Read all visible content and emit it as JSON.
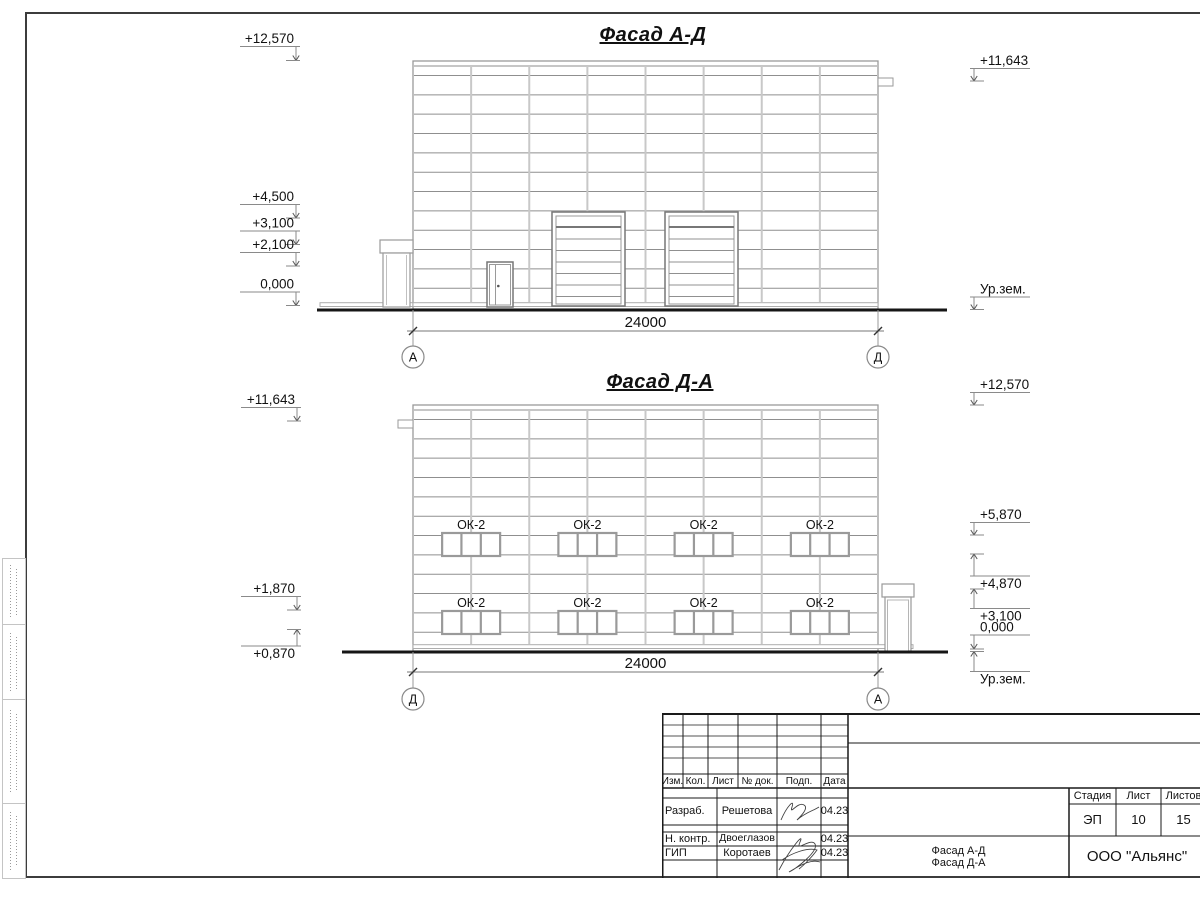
{
  "drawing": {
    "facade_top": {
      "title": "Фасад А-Д",
      "dimension": "24000",
      "axis_left": "А",
      "axis_right": "Д",
      "marks_left": [
        {
          "label": "+12,570",
          "shelf": 46.5,
          "tip": 60.5,
          "dir": "down"
        },
        {
          "label": "+4,500",
          "shelf": 204.5,
          "tip": 218,
          "dir": "down"
        },
        {
          "label": "+3,100",
          "shelf": 231,
          "tip": 244.5,
          "dir": "down"
        },
        {
          "label": "+2,100",
          "shelf": 252.5,
          "tip": 266,
          "dir": "down"
        },
        {
          "label": "0,000",
          "shelf": 292,
          "tip": 305.5,
          "dir": "down"
        }
      ],
      "marks_right": [
        {
          "label": "+11,643",
          "shelf": 68.5,
          "tip": 81,
          "dir": "down"
        },
        {
          "label": "Ур.зем.",
          "shelf": 297,
          "tip": 309.5,
          "dir": "down"
        }
      ]
    },
    "facade_bottom": {
      "title": "Фасад Д-А",
      "dimension": "24000",
      "axis_left": "Д",
      "axis_right": "А",
      "window_label": "ОК-2",
      "marks_left": [
        {
          "label": "+11,643",
          "shelf": 407.5,
          "tip": 421,
          "dir": "down"
        },
        {
          "label": "+1,870",
          "shelf": 596.5,
          "tip": 610,
          "dir": "down"
        },
        {
          "label": "+0,870",
          "shelf": 646,
          "tip": 629.5,
          "dir": "up"
        }
      ],
      "marks_right": [
        {
          "label": "+12,570",
          "shelf": 392.5,
          "tip": 405,
          "dir": "down"
        },
        {
          "label": "+5,870",
          "shelf": 522.5,
          "tip": 535,
          "dir": "down"
        },
        {
          "label": "+4,870",
          "shelf": 576,
          "tip": 554,
          "dir": "up"
        },
        {
          "label": "+3,100",
          "shelf": 608.5,
          "tip": 589,
          "dir": "up"
        },
        {
          "label": "0,000",
          "shelf": 635,
          "tip": 649,
          "dir": "down"
        },
        {
          "label": "Ур.зем.",
          "shelf": 671.5,
          "tip": 651.5,
          "dir": "up"
        }
      ]
    }
  },
  "titleblock": {
    "revision_headers": [
      "Изм.",
      "Кол.",
      "Лист",
      "№ док.",
      "Подп.",
      "Дата"
    ],
    "signers": [
      {
        "role": "Разраб.",
        "name": "Решетова",
        "date": "04.23"
      },
      {
        "role": "Н. контр.",
        "name": "Двоеглазов",
        "date": "04.23"
      },
      {
        "role": "ГИП",
        "name": "Коротаев",
        "date": "04.23"
      }
    ],
    "stage_label": "Стадия",
    "sheet_label": "Лист",
    "sheets_label": "Листов",
    "stage": "ЭП",
    "sheet": "10",
    "sheets": "15",
    "doc_title": [
      "Фасад А-Д",
      "Фасад Д-А"
    ],
    "company": "ООО \"Альянс\""
  }
}
